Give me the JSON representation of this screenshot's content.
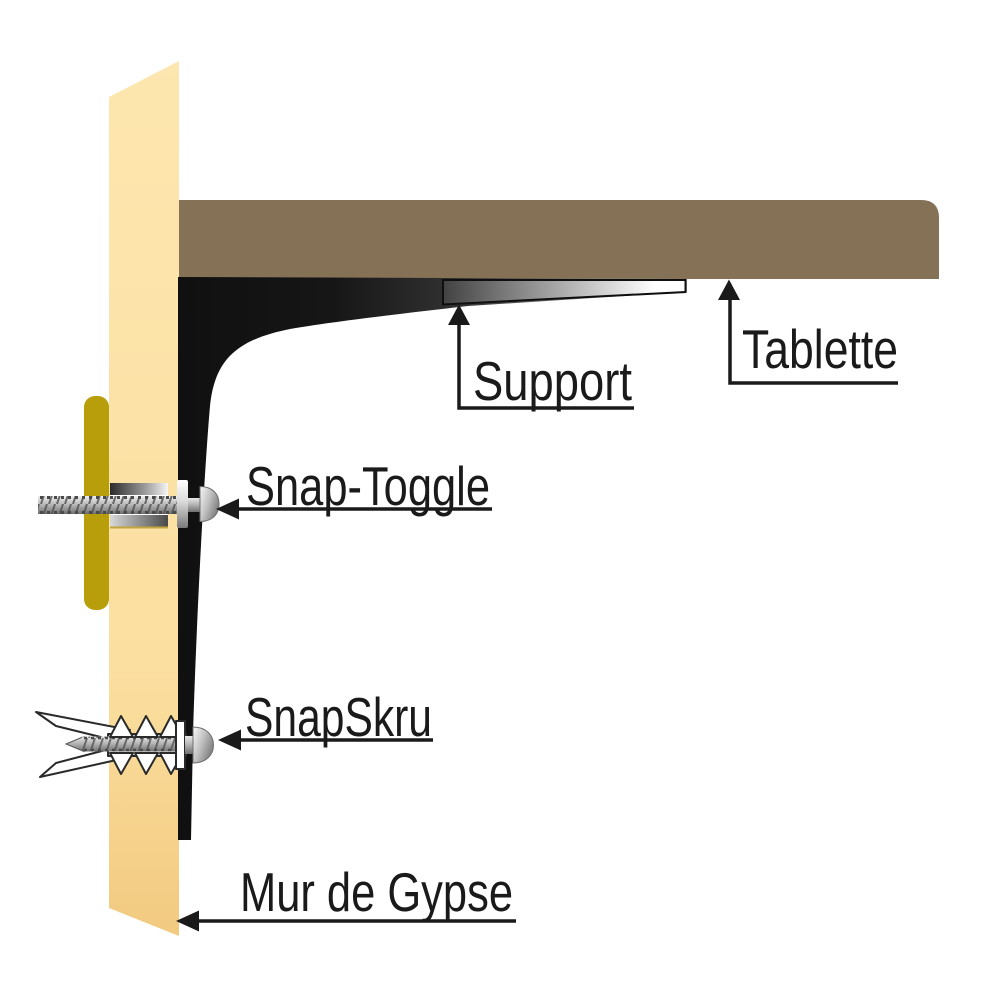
{
  "figure": {
    "type": "shelf-anchor-installation-diagram",
    "background_color": "#ffffff",
    "line_color": "#1a1a1a",
    "labels": {
      "shelf": "Tablette",
      "bracket": "Support",
      "toggle_anchor": "Snap-Toggle",
      "screw_anchor": "SnapSkru",
      "wall": "Mur de Gypse"
    },
    "colors": {
      "shelf_board": "#847156",
      "wall_top": "#FDE6AF",
      "wall_mid": "#FBDFA0",
      "wall_bottom": "#F2CA80",
      "wood_strip": "#B89E0A",
      "bracket_dark": "#141414",
      "metal_highlight": "#F5F5F5",
      "metal_shadow": "#6E6E6E",
      "anchor_white": "#FFFFFF"
    }
  }
}
